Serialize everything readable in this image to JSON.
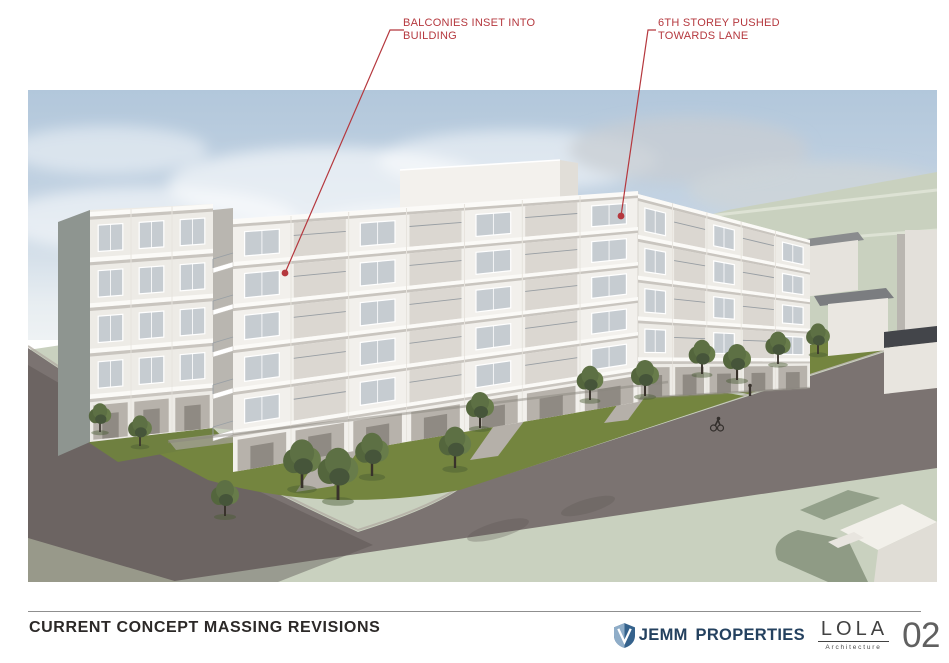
{
  "slide": {
    "title": "CURRENT CONCEPT MASSING REVISIONS",
    "page_number": "02"
  },
  "annotations": [
    {
      "id": "balconies",
      "line1": "BALCONIES INSET INTO",
      "line2": "BUILDING",
      "target": "balcony slab on left wing",
      "color": "#b5383e"
    },
    {
      "id": "sixth-storey",
      "line1": "6TH STOREY PUSHED",
      "line2": "TOWARDS LANE",
      "target": "upper storey near lane",
      "color": "#b5383e"
    }
  ],
  "branding": {
    "jemm": {
      "name": "JEMM PROPERTIES",
      "icon": "shield-icon",
      "color": "#24415f"
    },
    "lola": {
      "name": "LOLA",
      "tagline": "Architecture",
      "color": "#424242"
    }
  },
  "colors": {
    "annotation_red": "#b5383e",
    "sky": "#b6cade",
    "grass": "#74853f",
    "street": "#7b7371",
    "field": "#c9d1bf",
    "massing_white": "#f2f0ec"
  }
}
